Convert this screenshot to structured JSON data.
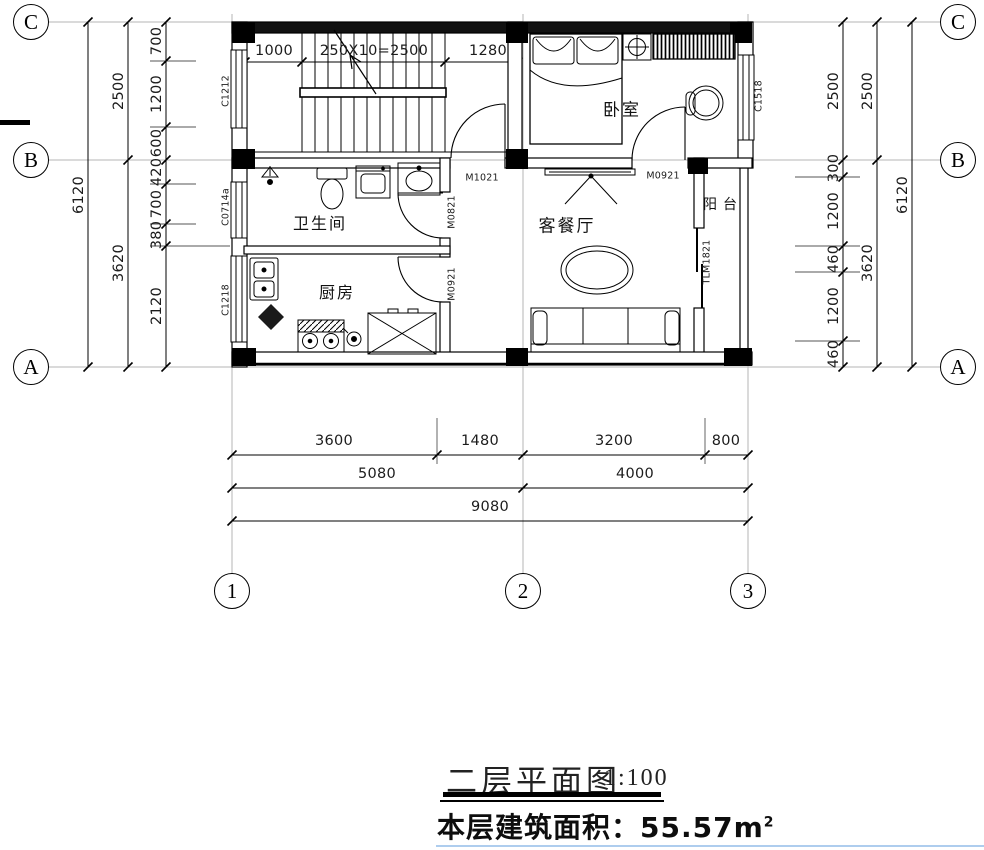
{
  "drawing": {
    "title": "二层平面图",
    "scale": "1:100",
    "area_label": "本层建筑面积：",
    "area_value": "55.57m",
    "area_sup": "2"
  },
  "grid": {
    "left": [
      "C",
      "B",
      "A"
    ],
    "right": [
      "C",
      "B",
      "A"
    ],
    "bottom": [
      "1",
      "2",
      "3"
    ]
  },
  "rooms": {
    "bedroom": "卧室",
    "bathroom": "卫生间",
    "kitchen": "厨房",
    "living_dining": "客餐厅",
    "balcony": "阳台"
  },
  "openings": {
    "window_stair": "C1212",
    "window_bath": "C0714a",
    "window_kitchen": "C1218",
    "window_bedroom": "C1518",
    "door_hall": "M1021",
    "door_bath": "M0821",
    "door_kitchen": "M0921",
    "door_bedroom": "M0921",
    "door_balcony": "TLM1821"
  },
  "dimensions": {
    "top": [
      "1000",
      "250X10=2500",
      "1280"
    ],
    "left_inner": [
      "700",
      "1200",
      "600",
      "420",
      "700",
      "380",
      "2120"
    ],
    "left_mid": [
      "2500",
      "3620"
    ],
    "left_outer": [
      "6120"
    ],
    "right_inner": [
      "2500",
      "300",
      "1200",
      "460",
      "1200",
      "460"
    ],
    "right_mid": [
      "2500",
      "3620"
    ],
    "right_outer": [
      "6120"
    ],
    "bottom_row1": [
      "3600",
      "1480",
      "3200",
      "800"
    ],
    "bottom_row2": [
      "5080",
      "4000"
    ],
    "bottom_row3": [
      "9080"
    ]
  }
}
